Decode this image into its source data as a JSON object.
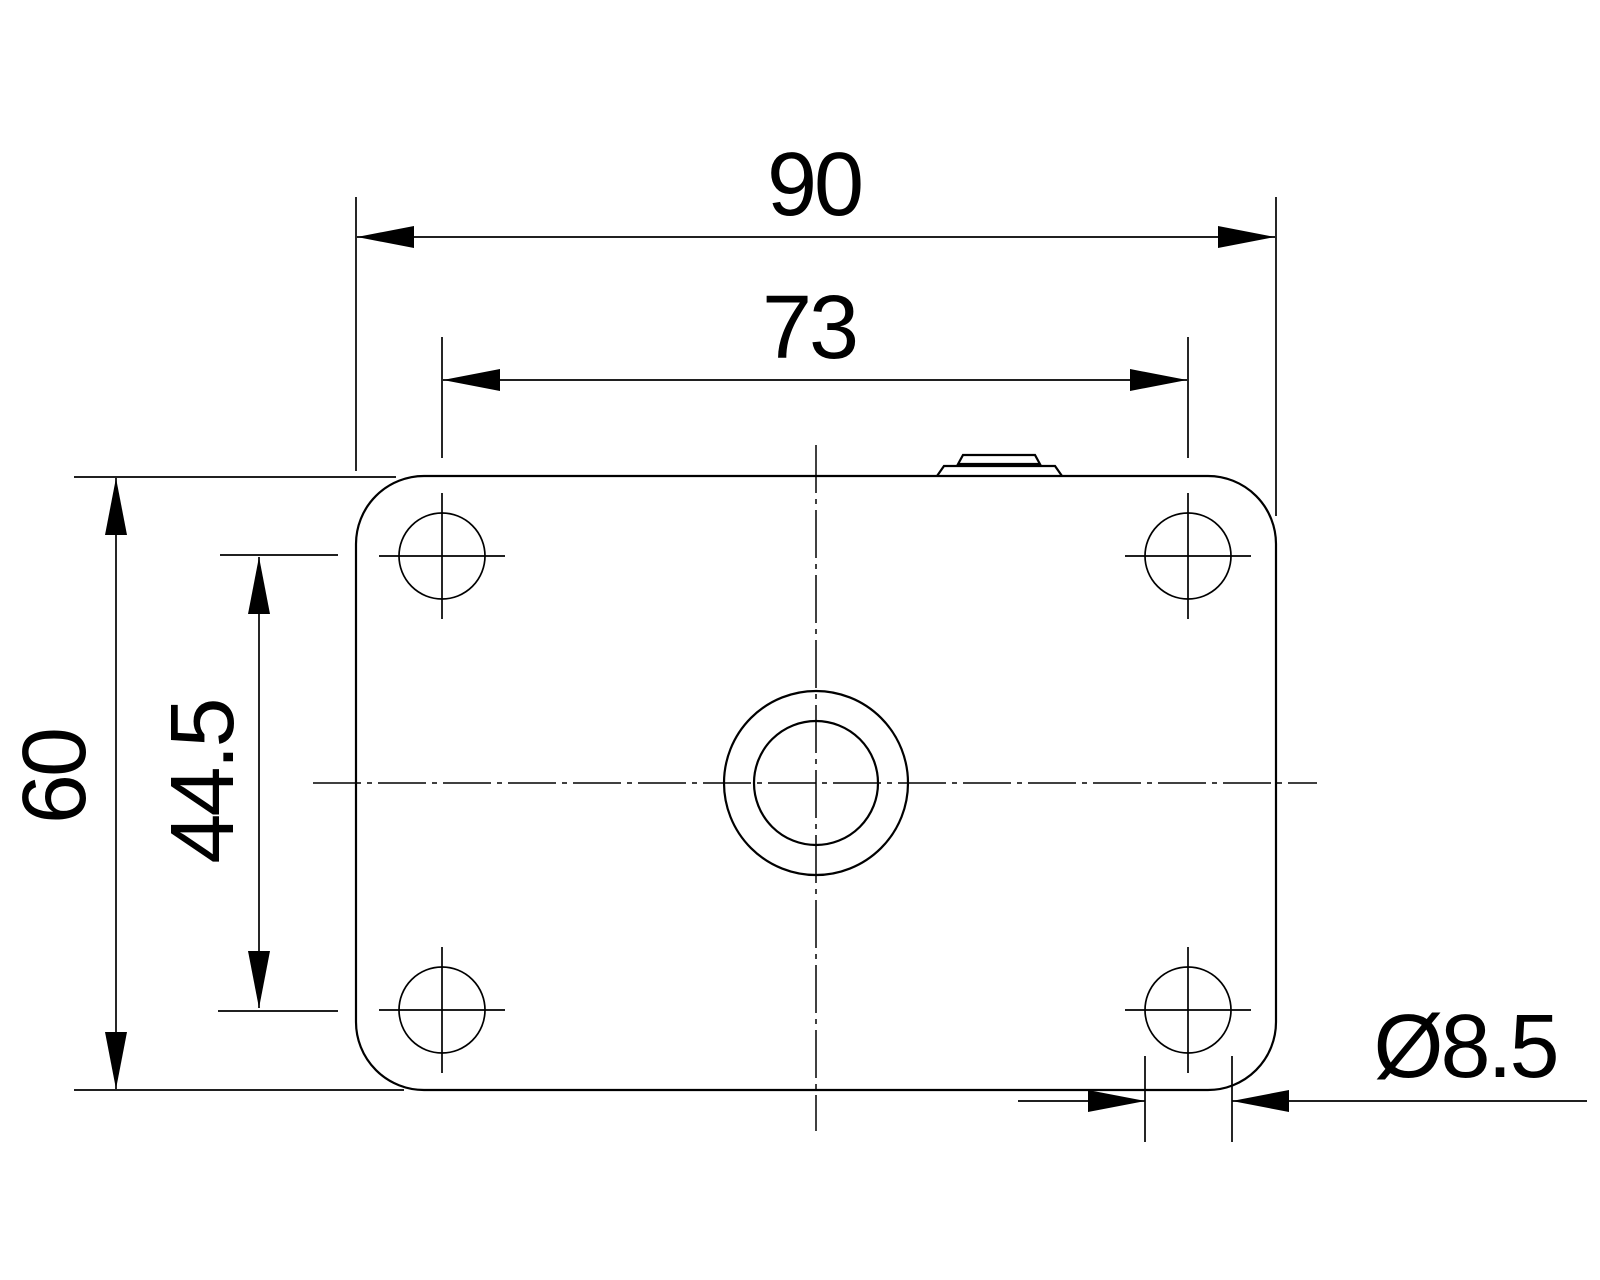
{
  "drawing": {
    "description": "flange plate dimension drawing, top view",
    "labels": {
      "overall_width": "90",
      "hole_spacing_horizontal": "73",
      "overall_height": "60",
      "hole_spacing_vertical": "44.5",
      "hole_diameter": "Ø8.5"
    },
    "colors": {
      "line": "#000000",
      "background": "#ffffff"
    }
  }
}
